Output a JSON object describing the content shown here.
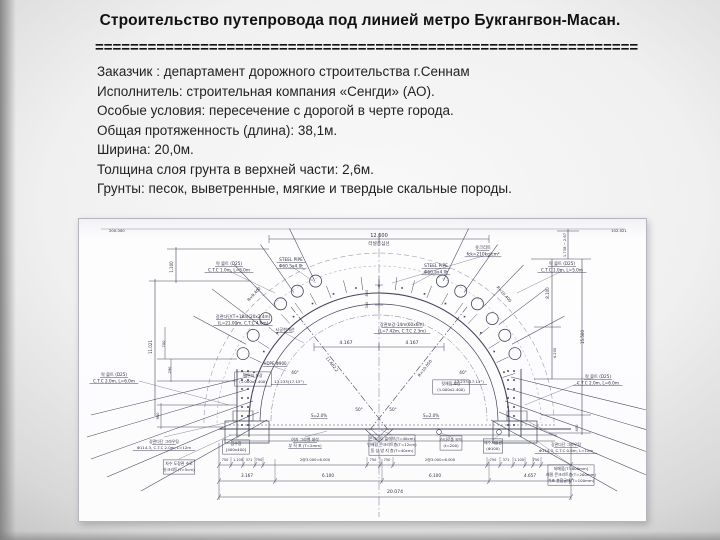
{
  "slide": {
    "title": "Строительство путепровода под линией метро Букгангвон-Масан.",
    "separator": "==============================================================",
    "lines": [
      "Заказчик : департамент дорожного строительства г.Сеннам",
      "Исполнитель: строительная компания «Сенгди» (АО).",
      "Особые условия: пересечение с дорогой в черте города.",
      "Общая протяженность (длина): 38,1м.",
      "Ширина: 20,0м.",
      "Толщина слоя грунта в верхней части: 2,6м.",
      "Грунты: песок, выветренные, мягкие и твердые скальные породы."
    ]
  },
  "drawing": {
    "labels": {
      "corner_l": {
        "lines": [
          "200.000"
        ]
      },
      "corner_r": {
        "lines": [
          "102.021"
        ]
      },
      "dim_top": {
        "lines": [
          "12.600"
        ]
      },
      "centerline": {
        "lines": [
          "터널중심선"
        ]
      },
      "apex_800": {
        "lines": [
          "800"
        ]
      },
      "apex_300": {
        "lines": [
          "300"
        ]
      },
      "steel_pipe_l": {
        "lines": [
          "STEEL PIPE",
          "Φ60.5x4.0t"
        ]
      },
      "steel_pipe_r": {
        "lines": [
          "STEEL PIPE",
          "Φ60.5x4.0t"
        ]
      },
      "fck_label": {
        "lines": [
          "숏크리트",
          "fck=210kg/cm²"
        ]
      },
      "grout_arc_l": {
        "lines": [
          "강관다단(T+18a)(20x2.4m)",
          "(L=21.00m, C.T.C 4.0m)"
        ]
      },
      "grout_arc_r": {
        "lines": [
          "강관보강-14m(60x6m)",
          "(L=7.42m, C.T.C 2.3m)"
        ]
      },
      "limit_line": {
        "lines": [
          "시공한계선"
        ]
      },
      "dim_4167_l": {
        "lines": [
          "4.167"
        ]
      },
      "dim_4167_r": {
        "lines": [
          "4.167"
        ]
      },
      "diag_l": {
        "lines": [
          "11.682.2"
        ]
      },
      "diag_r": {
        "lines": [
          "R=10.050"
        ]
      },
      "r_arc_l": {
        "lines": [
          "R=9.400"
        ]
      },
      "r_arc_r": {
        "lines": [
          "R=10.400"
        ]
      },
      "angle40_l": {
        "lines": [
          "40°"
        ]
      },
      "t17_l": {
        "lines": [
          "17.233(17.15°)"
        ]
      },
      "angle40_r": {
        "lines": [
          "40°"
        ]
      },
      "t17_r": {
        "lines": [
          "17.233(17.15°)"
        ]
      },
      "angle50_l": {
        "lines": [
          "50°"
        ]
      },
      "angle50_r": {
        "lines": [
          "50°"
        ]
      },
      "slope_l": {
        "lines": [
          "S=2.0%"
        ]
      },
      "slope_r": {
        "lines": [
          "S=2.0%"
        ]
      },
      "hdpe": {
        "lines": [
          "HDPE Φ900"
        ]
      },
      "backfill_l": {
        "lines": [
          "배면지 보강",
          "(1.000x2.400)"
        ]
      },
      "backfill_r": {
        "lines": [
          "뒷채움 보강",
          "(1.000x2.400)"
        ]
      },
      "rockbolt_tl": {
        "lines": [
          "락 볼트 (D25)",
          "C.T.C 1.0m, L=5.0m"
        ]
      },
      "rockbolt_tr": {
        "lines": [
          "락 볼트 (D25)",
          "C.T.C 1.0m, L=5.0m"
        ]
      },
      "rockbolt_ml": {
        "lines": [
          "락 볼트 (D25)",
          "C.T.C 2.0m, L=6.0m"
        ]
      },
      "rockbolt_mr": {
        "lines": [
          "락 볼트 (D25)",
          "C.T.C 2.0m, L=6.0m"
        ]
      },
      "grout_bl": {
        "lines": [
          "강관다단 그라우팅",
          "Φ114.3, C.T.C 2.0m, L=12m"
        ]
      },
      "note_bl": {
        "lines": [
          "차수 도장관 수로",
          "숏크리트(T=5cm)"
        ]
      },
      "sump": {
        "lines": [
          "집수정",
          "[400x400]"
        ]
      },
      "filter": {
        "lines": [
          "여과 그라벨 쇄석",
          "부 직 포 (T=2mm)"
        ]
      },
      "slab_box": {
        "lines": [
          "콘크리트 슬래브(T=40cm)",
          "빈배합 콘크리트층(T=12cm)",
          "동 상 방 지 층(T=40cm)"
        ]
      },
      "styro": {
        "lines": [
          "스티로폼 보드",
          "(t=200)"
        ]
      },
      "drainpipe": {
        "lines": [
          "배수시설관",
          "(Φ100)"
        ]
      },
      "grout_br": {
        "lines": [
          "강관다단 그라우팅",
          "Φ114.3, C.T.C 0.6m, L=12m"
        ]
      },
      "fill_box": {
        "lines": [
          "되메움[T=800mm]",
          "래밀 콘크리트층(T=200mm)",
          "기초 혼합골재(T=100mm)"
        ]
      },
      "vdim_1100": {
        "lines": [
          "1.100"
        ]
      },
      "vdim_11021": {
        "lines": [
          "11.021"
        ]
      },
      "vdim_700": {
        "lines": [
          "700"
        ]
      },
      "vdim_290": {
        "lines": [
          "290"
        ]
      },
      "vdim_980": {
        "lines": [
          "980"
        ]
      },
      "vdim_1738": {
        "lines": [
          "1.738 ~ 2.67"
        ]
      },
      "vdim_8100": {
        "lines": [
          "8.100"
        ]
      },
      "vdim_4200": {
        "lines": [
          "4.200"
        ]
      },
      "vdim_15500": {
        "lines": [
          "15.500"
        ]
      },
      "vdim_400": {
        "lines": [
          "400"
        ]
      },
      "a_750_1": {
        "lines": [
          "750"
        ]
      },
      "a_1100_l": {
        "lines": [
          "1.100"
        ]
      },
      "a_371_l": {
        "lines": [
          "371"
        ]
      },
      "a_750_2": {
        "lines": [
          "750"
        ]
      },
      "a_6000_l": {
        "lines": [
          "2@3.000=6.000"
        ]
      },
      "a_750_3": {
        "lines": [
          "750"
        ]
      },
      "a_750_4": {
        "lines": [
          "750"
        ]
      },
      "a_6000_r": {
        "lines": [
          "2@3.000=6.000"
        ]
      },
      "a_750_5": {
        "lines": [
          "750"
        ]
      },
      "a_371_r": {
        "lines": [
          "371"
        ]
      },
      "a_1100_r": {
        "lines": [
          "1.100"
        ]
      },
      "a_750_6": {
        "lines": [
          "750"
        ]
      },
      "b_3167": {
        "lines": [
          "3.167"
        ]
      },
      "b_6100_l": {
        "lines": [
          "6.100"
        ]
      },
      "b_6100_r": {
        "lines": [
          "6.100"
        ]
      },
      "b_4657": {
        "lines": [
          "4.657"
        ]
      },
      "c_total": {
        "lines": [
          "20.074"
        ]
      }
    }
  }
}
